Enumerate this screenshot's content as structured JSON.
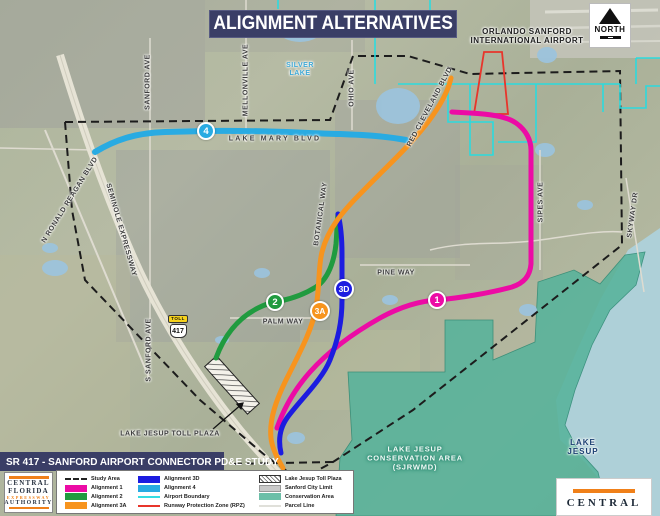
{
  "title": "ALIGNMENT ALTERNATIVES",
  "footer_banner": "SR 417 - SANFORD AIRPORT CONNECTOR PD&E STUDY",
  "north_label": "NORTH",
  "airport": {
    "line1": "ORLANDO SANFORD",
    "line2": "INTERNATIONAL AIRPORT"
  },
  "roads": {
    "sanford_ave": "SANFORD AVE",
    "mellonville_ave": "MELLONVILLE AVE",
    "ohio_ave": "OHIO AVE",
    "red_cleveland": "RED CLEVELAND BLVD",
    "lake_mary": "LAKE MARY BLVD",
    "ronald_reagan": "N RONALD REAGAN BLVD",
    "seminole": "SEMINOLE EXPRESSWAY",
    "botanical": "BOTANICAL WAY",
    "pine": "PINE WAY",
    "sipes": "SIPES AVE",
    "skyway": "SKYWAY DR",
    "palm": "PALM WAY",
    "s_sanford": "S SANFORD AVE"
  },
  "places": {
    "silver_lake_1": "SILVER",
    "silver_lake_2": "LAKE",
    "lake_jesup_1": "LAKE",
    "lake_jesup_2": "JESUP",
    "conservation_1": "LAKE JESUP",
    "conservation_2": "CONSERVATION AREA",
    "conservation_3": "(SJRWMD)",
    "toll_plaza": "LAKE JESUP TOLL PLAZA"
  },
  "shield": {
    "toll": "TOLL",
    "route": "417"
  },
  "badges": [
    {
      "id": "1",
      "color": "#ec0ba5"
    },
    {
      "id": "2",
      "color": "#209b3f"
    },
    {
      "id": "3A",
      "color": "#f7941e"
    },
    {
      "id": "3D",
      "color": "#1c1ce0"
    },
    {
      "id": "4",
      "color": "#29abe2"
    }
  ],
  "legend": {
    "col1": [
      {
        "label": "Study Area"
      },
      {
        "label": "Alignment 1",
        "color": "#ec0ba5"
      },
      {
        "label": "Alignment 2",
        "color": "#209b3f"
      },
      {
        "label": "Alignment 3A",
        "color": "#f7941e"
      }
    ],
    "col2": [
      {
        "label": "Alignment 3D",
        "color": "#1c1ce0"
      },
      {
        "label": "Alignment 4",
        "color": "#29abe2"
      },
      {
        "label": "Airport Boundary",
        "color": "#35dde2"
      },
      {
        "label": "Runway Protection Zone (RPZ)",
        "color": "#e8352b"
      }
    ],
    "col3": [
      {
        "label": "Lake Jesup Toll Plaza"
      },
      {
        "label": "Sanford City Limit",
        "color": "#c9c9c9"
      },
      {
        "label": "Conservation Area",
        "color": "#6cbfa8"
      },
      {
        "label": "Parcel Line",
        "color": "#e0e0da"
      }
    ]
  },
  "cfx_logo": {
    "l1": "CENTRAL",
    "l2": "FLORIDA",
    "l3": "EXPRESSWAY",
    "l4": "AUTHORITY"
  },
  "bottom_logo": {
    "text": "CENTRAL"
  }
}
